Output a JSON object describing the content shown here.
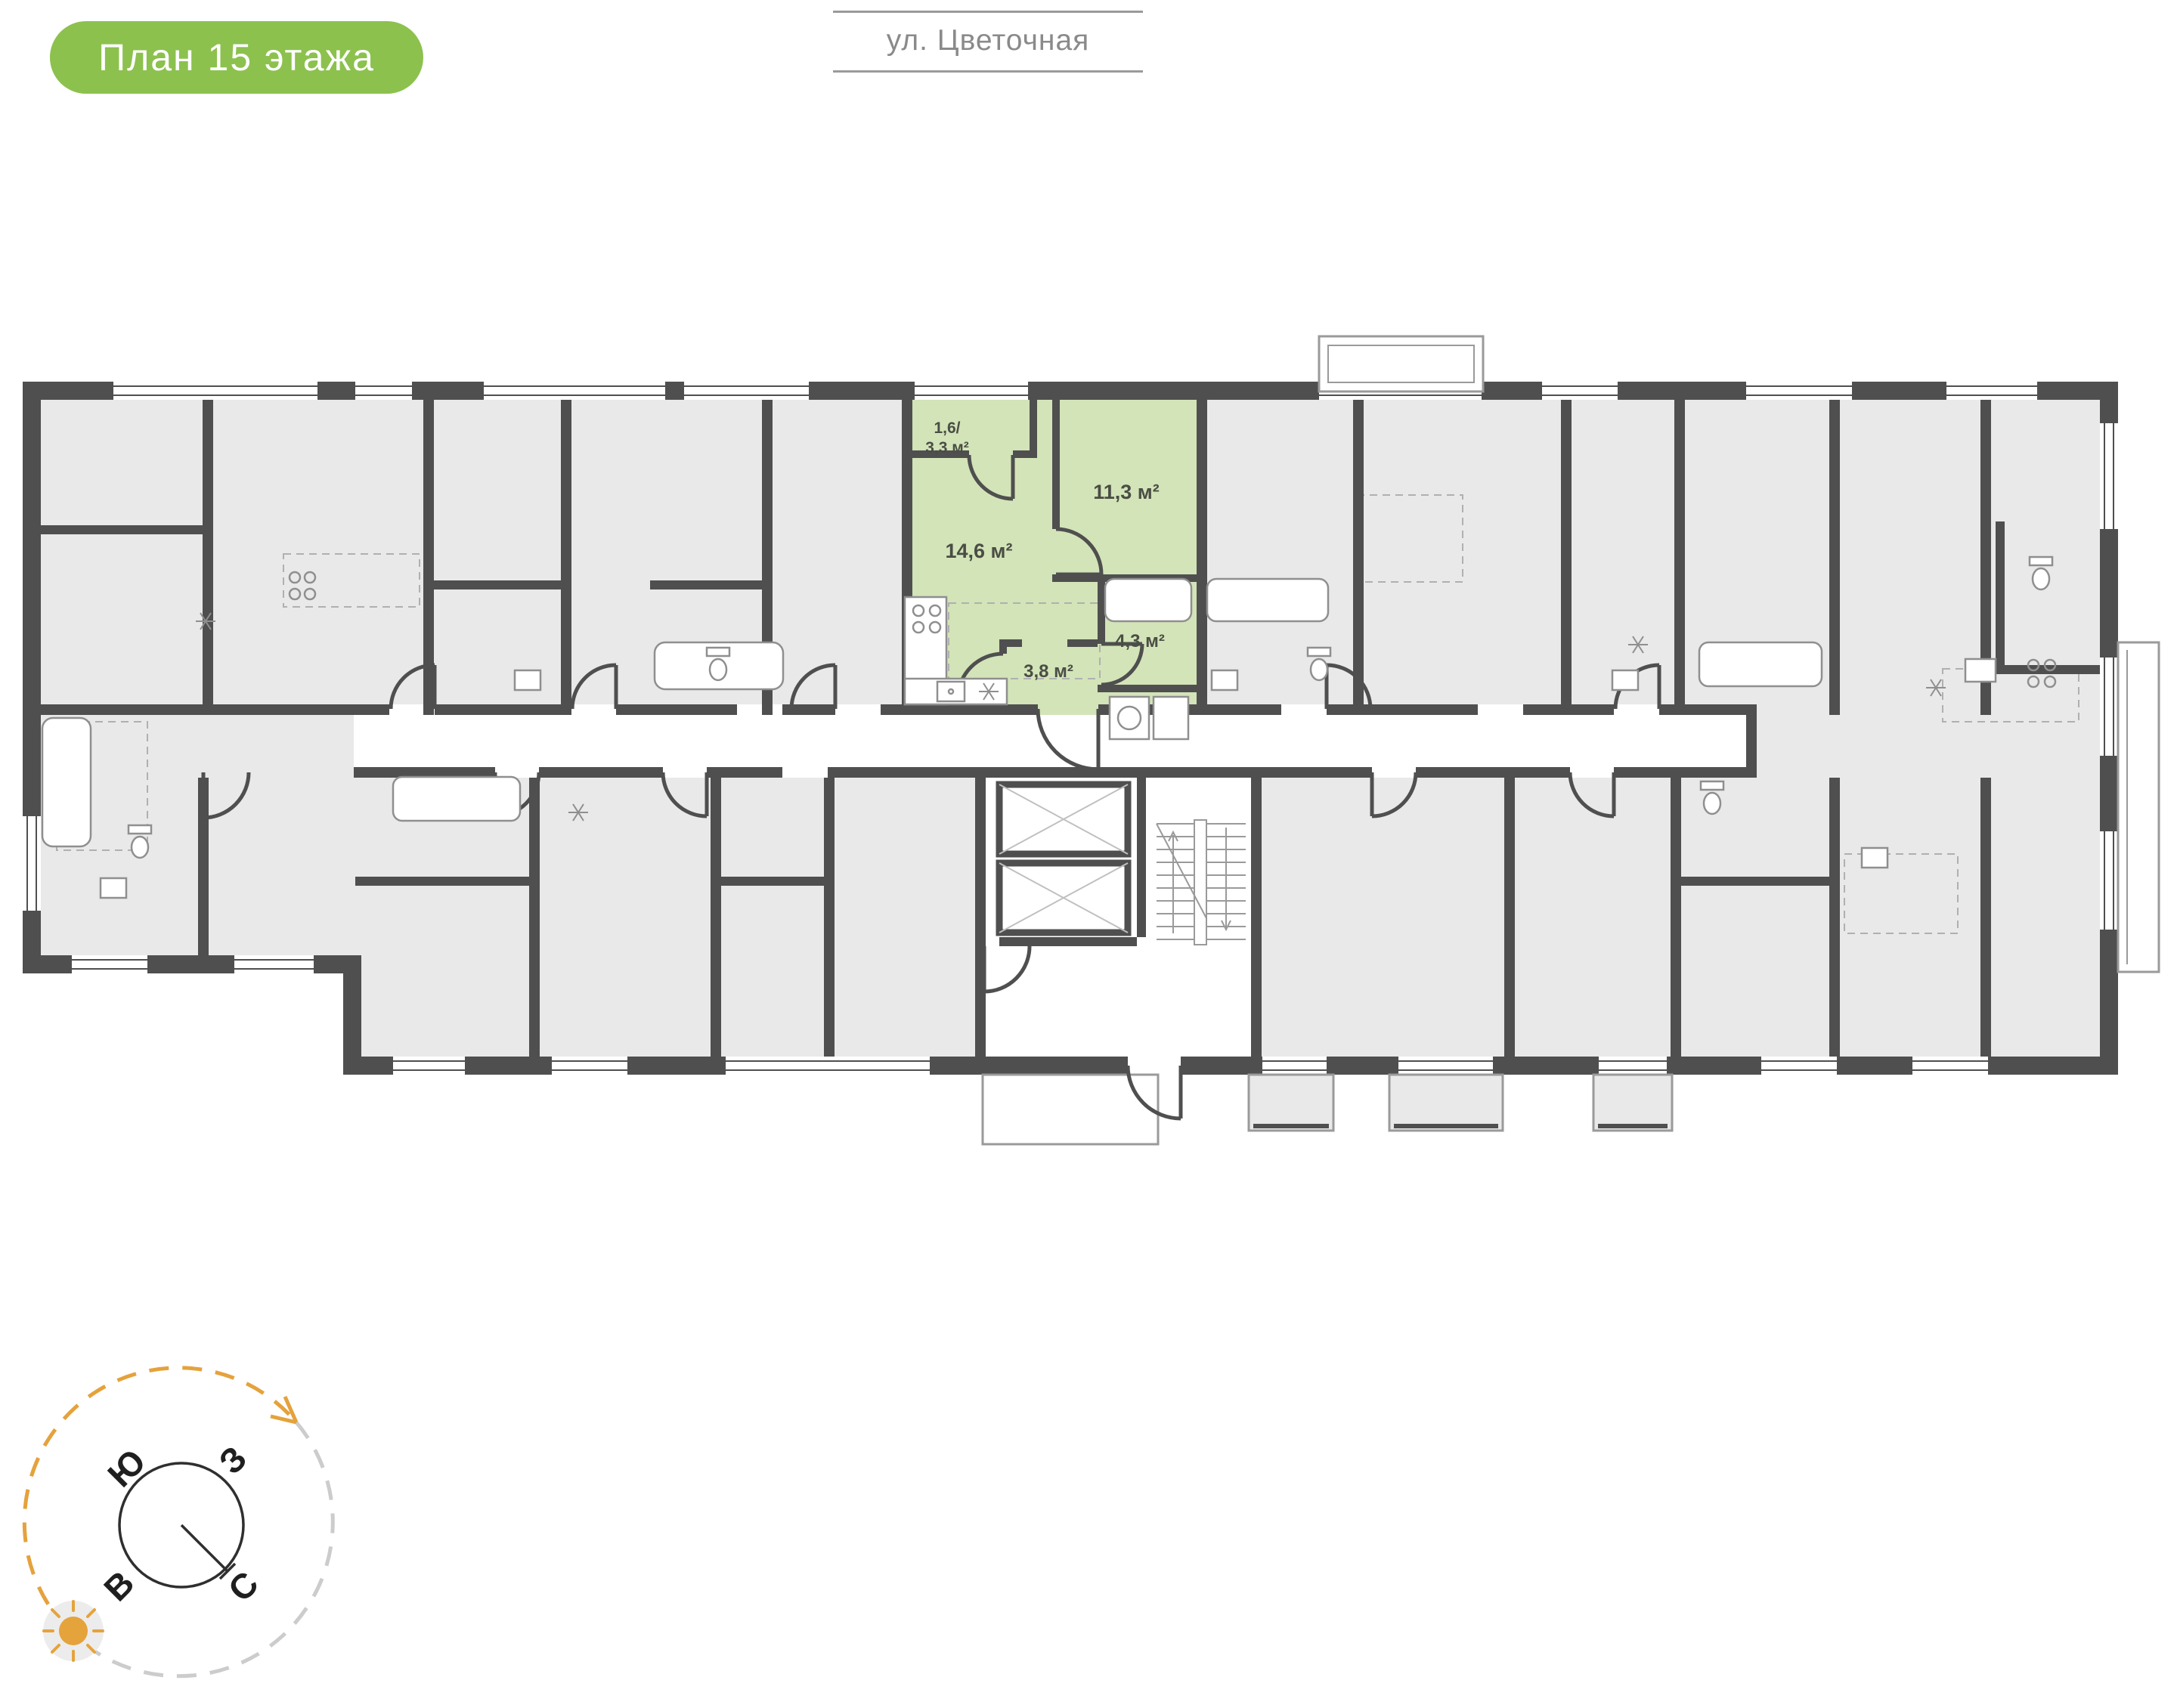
{
  "badge": {
    "label": "План 15 этажа"
  },
  "street": {
    "label": "ул. Цветочная"
  },
  "floor_plan": {
    "highlighted_apartment": {
      "rooms": [
        {
          "name": "balcony",
          "area_line1": "1,6/",
          "area_line2": "3,3 м²"
        },
        {
          "name": "kitchen-living-room",
          "area": "14,6 м²"
        },
        {
          "name": "bedroom",
          "area": "11,3 м²"
        },
        {
          "name": "hallway",
          "area": "3,8 м²"
        },
        {
          "name": "bathroom",
          "area": "4,3 м²"
        }
      ]
    }
  },
  "compass": {
    "labels": {
      "south": "Ю",
      "west": "З",
      "east": "В",
      "north": "С"
    }
  },
  "colors": {
    "badge_green": "#8cc14e",
    "apartment_highlight": "#d3e4b8",
    "walls": "#4f4f4f",
    "rooms_fill": "#e9e9e9",
    "compass_accent": "#e5a23c",
    "street_text": "#8a8a8a"
  }
}
